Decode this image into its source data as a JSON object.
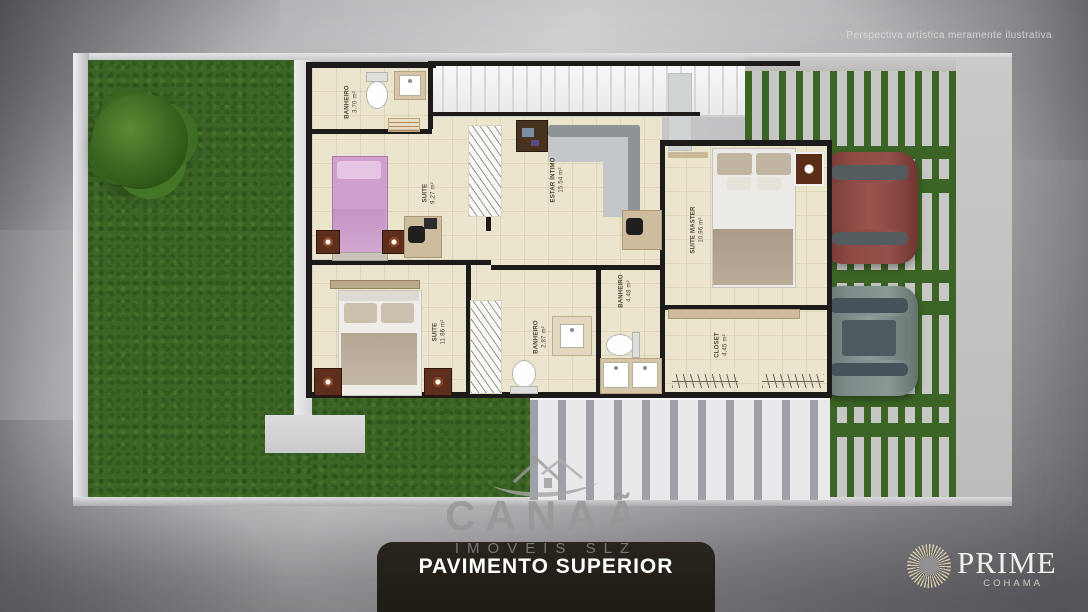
{
  "disclaimer": "Perspectiva artística meramente ilustrativa",
  "plan": {
    "title": "PAVIMENTO SUPERIOR",
    "rooms": [
      {
        "name": "BANHEIRO",
        "area": "3.70 m²"
      },
      {
        "name": "SUITE",
        "area": "9.27 m²"
      },
      {
        "name": "ESTAR ÍNTIMO",
        "area": "15.54 m²"
      },
      {
        "name": "SUITE MASTER",
        "area": "10.96 m²"
      },
      {
        "name": "SUITE",
        "area": "11.86 m²"
      },
      {
        "name": "BANHEIRO",
        "area": "2.87 m²"
      },
      {
        "name": "BANHEIRO",
        "area": "4.48 m²"
      },
      {
        "name": "CLOSET",
        "area": "4.45 m²"
      }
    ]
  },
  "watermark": {
    "brand": "CANAÃ",
    "tagline": "IMÓVEIS SLZ"
  },
  "developer": {
    "brand": "PRIME",
    "sub": "COHAMA"
  },
  "colors": {
    "grass": "#3c6426",
    "floor": "#ece5cd",
    "wall": "#1c1b19",
    "title_bar": "#221e17",
    "car_red": "#8a4540",
    "car_gray": "#7e8d8b",
    "brand_gold": "#d8cba8"
  }
}
